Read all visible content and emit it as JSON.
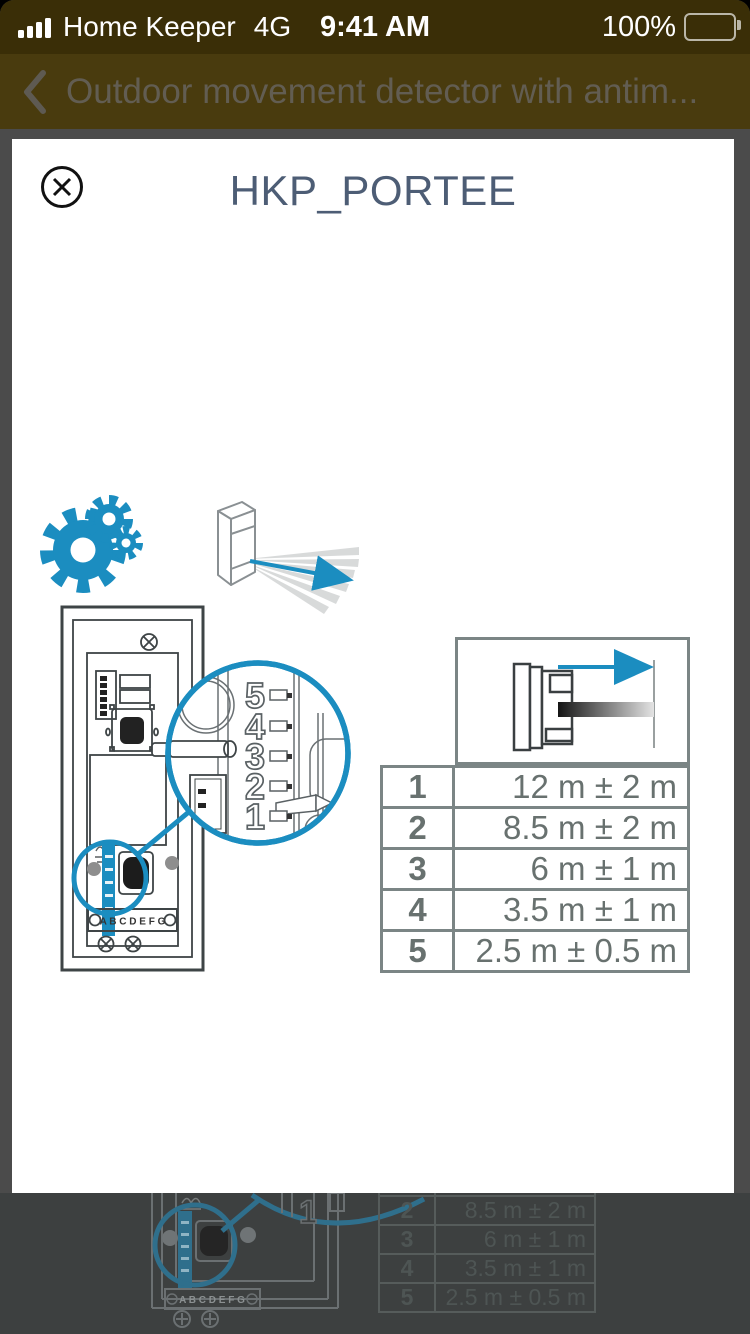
{
  "status_bar": {
    "carrier": "Home Keeper",
    "network": "4G",
    "time": "9:41 AM",
    "battery_percent": "100%"
  },
  "nav_bar": {
    "title": "Outdoor movement detector with antim..."
  },
  "modal": {
    "title": "HKP_PORTEE"
  },
  "diagram": {
    "magnifier_labels": [
      "5",
      "4",
      "3",
      "2",
      "1"
    ],
    "terminal_labels": "A B C D E F G"
  },
  "range_table": {
    "type": "table",
    "columns": [
      "dip_switch_position",
      "detection_range"
    ],
    "rows": [
      [
        "1",
        "12 m ± 2 m"
      ],
      [
        "2",
        "8.5 m ± 2 m"
      ],
      [
        "3",
        "6 m ± 1 m"
      ],
      [
        "4",
        "3.5 m ± 1 m"
      ],
      [
        "5",
        "2.5 m ± 0.5 m"
      ]
    ]
  },
  "colors": {
    "accent_blue": "#1b8dc0",
    "status_bg": "#3a2e07",
    "nav_bg": "#493b0e",
    "nav_title": "#625d52",
    "scrim": "#4b4b4b",
    "backdrop": "#3d4040",
    "modal_title": "#4d5d75",
    "table_border": "#7b8585",
    "table_text": "#68716f"
  }
}
